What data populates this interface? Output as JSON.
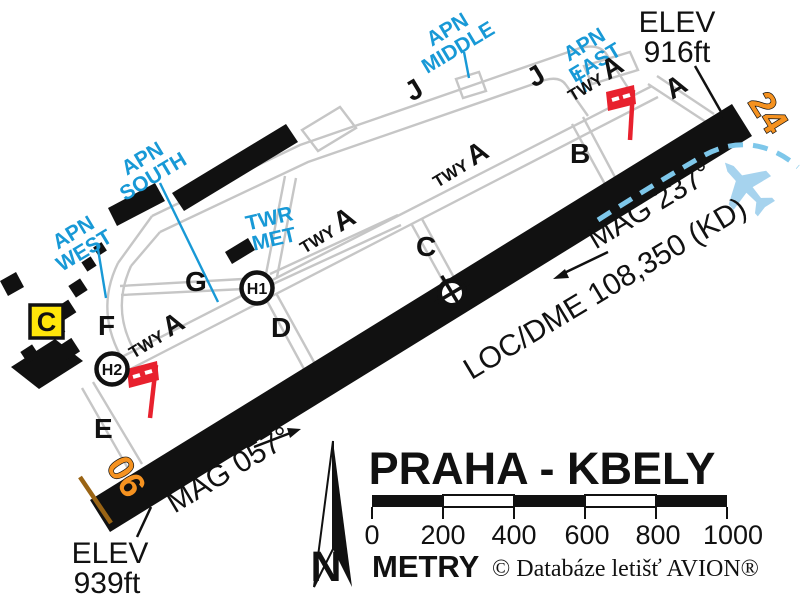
{
  "title": "PRAHA - KBELY",
  "map": {
    "runway": {
      "num_sw": "06",
      "num_ne": "24"
    },
    "headings": {
      "ne_course": "MAG 057°",
      "sw_course": "MAG 237°"
    },
    "nav": {
      "loc_dme": "LOC/DME 108,350 (KD)"
    },
    "elev_ne": {
      "l1": "ELEV",
      "l2": "916ft"
    },
    "elev_sw": {
      "l1": "ELEV",
      "l2": "939ft"
    },
    "aprons": {
      "west": [
        "APN",
        "WEST"
      ],
      "south": [
        "APN",
        "SOUTH"
      ],
      "middle": [
        "APN",
        "MIDDLE"
      ],
      "east": [
        "APN",
        "EAST"
      ]
    },
    "twr": [
      "TWR",
      "MET"
    ],
    "twy": {
      "prefix": "TWY",
      "main": "A"
    },
    "connectors": {
      "a": "A",
      "b": "B",
      "c": "C",
      "d": "D",
      "e": "E",
      "f": "F",
      "g": "G",
      "j": "J"
    },
    "helipads": {
      "h1": "H1",
      "h2": "H2"
    },
    "sign_c": "C"
  },
  "legend": {
    "airport_name": "PRAHA - KBELY",
    "scale": {
      "ticks": [
        "0",
        "200",
        "400",
        "600",
        "800",
        "1000"
      ],
      "unit": "METRY"
    },
    "copyright": "© Databáze letišť AVION®",
    "north": "N"
  },
  "colors": {
    "apron_label": "#1899d6",
    "runway_number": "#f59220",
    "windsock_red": "#e8212e",
    "approach_dash": "#7ec7ea",
    "aircraft_blue": "#a6d3ee",
    "taxiway_gray": "#c6c6c6",
    "sign_c_bg": "#ffe60a"
  }
}
